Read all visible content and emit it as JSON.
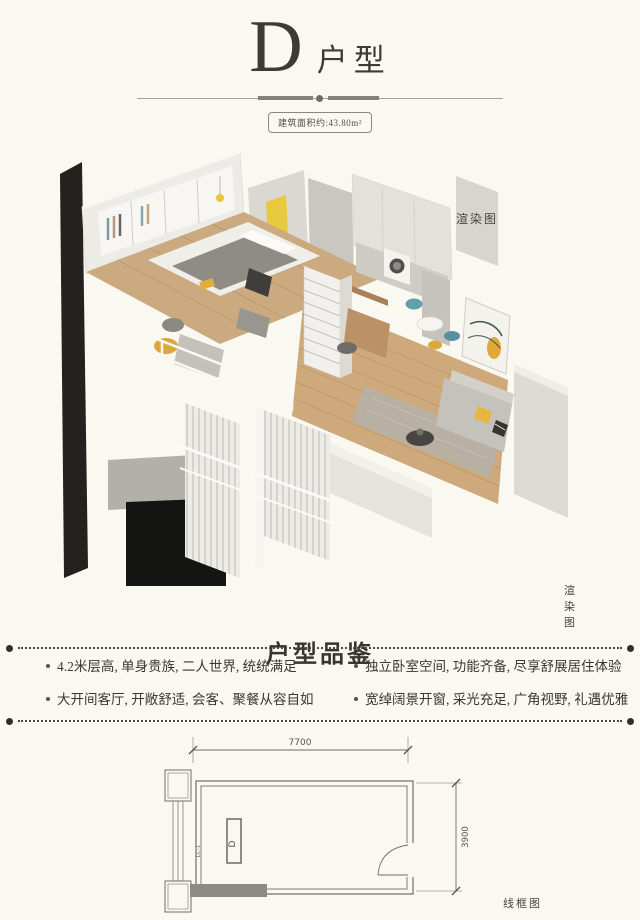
{
  "header": {
    "plan_letter": "D",
    "plan_suffix": "户型",
    "area_badge": "建筑面积约:43.80m²"
  },
  "render": {
    "label_top": "渲染图",
    "label_bottom": "渲染图"
  },
  "features": {
    "heading": "户型品鉴",
    "items": [
      {
        "label": "4.2米层高, 单身贵族, 二人世界, 统统满足"
      },
      {
        "label": "独立卧室空间, 功能齐备, 尽享舒展居住体验"
      },
      {
        "label": "大开间客厅, 开敞舒适, 会客、聚餐从容自如"
      },
      {
        "label": "宽绰阔景开窗, 采光充足, 广角视野, 礼遇优雅"
      }
    ]
  },
  "wireframe": {
    "label": "线框图",
    "width_dim": "7700",
    "height_dim": "3900",
    "unit_letter": "D",
    "window_code": "LC-1"
  },
  "colors": {
    "background": "#FAF9F1",
    "ink": "#3C3B35",
    "accent_yellow": "#E9C93E",
    "wood": "#CBAA80",
    "teal": "#63A0AD"
  }
}
